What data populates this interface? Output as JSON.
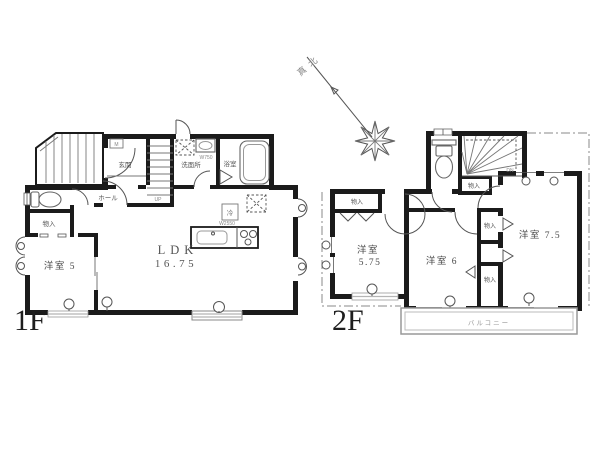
{
  "compass": {
    "north_label": "真北"
  },
  "floor1": {
    "floor_label": "1F",
    "room_genkan": "玄関",
    "room_hall": "ホール",
    "room_washroom": "洗面所",
    "room_bath": "浴室",
    "room_storage": "物入",
    "room_western5": "洋室 5",
    "ldk_name": "LDK",
    "ldk_area": "16.75",
    "stairs_label": "UP",
    "meter_label": "M",
    "fridge_label": "冷",
    "sink_size_label": "W750",
    "kitchen_size_label": "W2550"
  },
  "floor2": {
    "floor_label": "2F",
    "room_western575_name": "洋室",
    "room_western575_area": "5.75",
    "room_western6": "洋室 6",
    "room_western75": "洋室 7.5",
    "storage_label": "物入",
    "balcony_label": "バルコニー",
    "stairs_label": "DN"
  }
}
